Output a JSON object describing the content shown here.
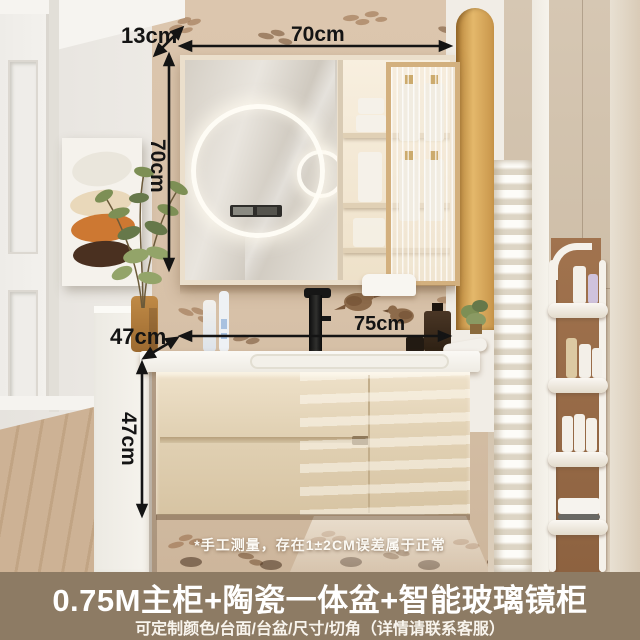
{
  "annotations": {
    "mirror_depth": "13cm",
    "mirror_width": "70cm",
    "mirror_height": "70cm",
    "counter_depth": "47cm",
    "counter_width": "75cm",
    "cabinet_height": "47cm"
  },
  "disclaimer": "*手工测量，存在1±2CM误差属于正常",
  "banner": {
    "title": "0.75M主柜+陶瓷一体盆+智能玻璃镜柜",
    "subtitle": "可定制颜色/台面/台盆/尺寸/切角（详情请联系客服）"
  },
  "colors": {
    "annotation_text": "#141414",
    "banner_background": "#8d7b64",
    "banner_text": "#ffffff",
    "wallpaper": "#d9c3aa",
    "vanity_cabinet": "#e5d5b8",
    "countertop": "#f7f4ee",
    "mirror_frame_wood": "#d3b07e",
    "niche_gold": "#d4a055",
    "led_light": "#fffdf4"
  }
}
